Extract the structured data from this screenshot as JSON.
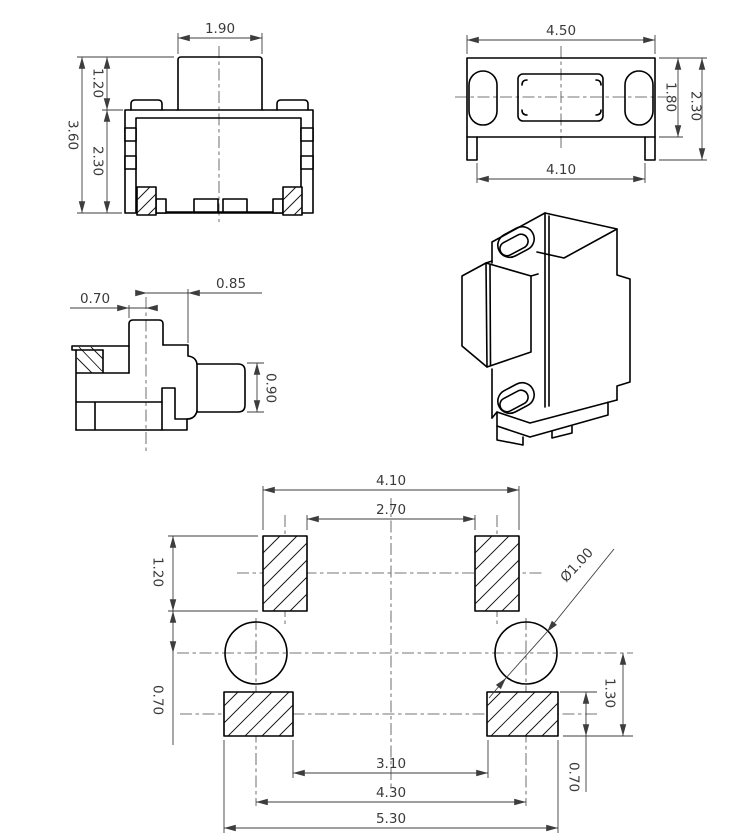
{
  "views": {
    "front": {
      "button_width": "1.90",
      "button_protrusion": "1.20",
      "overall_height": "3.60",
      "body_height": "2.30"
    },
    "top": {
      "body_width": "4.50",
      "body_depth": "1.80",
      "depth_with_terminals": "2.30",
      "terminal_span": "4.10"
    },
    "side": {
      "stem_offset": "0.70",
      "body_offset": "0.85",
      "stem_height": "0.90"
    },
    "footprint": {
      "top_pad_span_outer": "4.10",
      "top_pad_span_inner": "2.70",
      "top_pad_height": "1.20",
      "top_pad_to_hole": "0.70",
      "hole_diameter": "Ø1.00",
      "hole_to_pad_edge": "1.30",
      "bottom_pad_span_inner": "3.10",
      "hole_span": "4.30",
      "bottom_pad_span_outer": "5.30",
      "bottom_pad_height": "0.70"
    }
  }
}
